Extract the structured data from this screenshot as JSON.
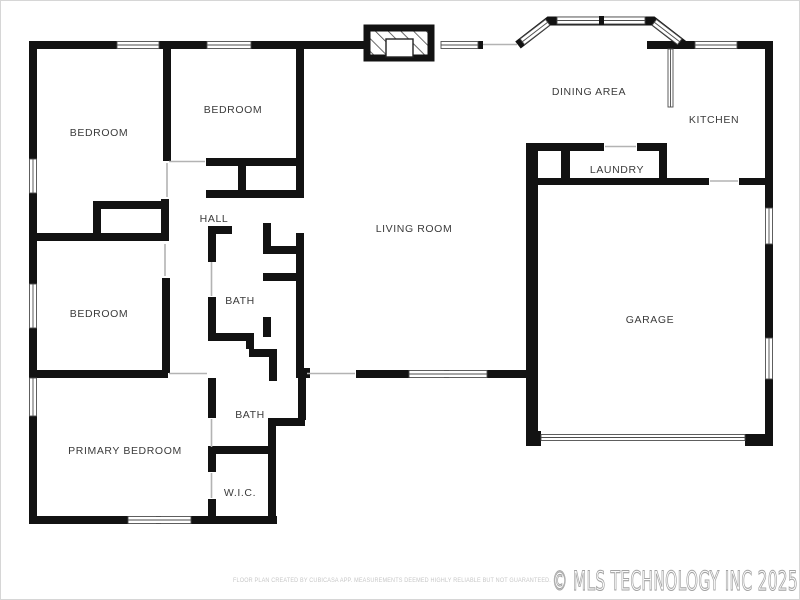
{
  "floor_plan": {
    "rooms": [
      {
        "id": "bedroom-top-left",
        "label": "BEDROOM"
      },
      {
        "id": "bedroom-top-middle",
        "label": "BEDROOM"
      },
      {
        "id": "hall",
        "label": "HALL"
      },
      {
        "id": "bedroom-left",
        "label": "BEDROOM"
      },
      {
        "id": "bath-upper",
        "label": "BATH"
      },
      {
        "id": "bath-lower",
        "label": "BATH"
      },
      {
        "id": "primary-bedroom",
        "label": "PRIMARY BEDROOM"
      },
      {
        "id": "wic",
        "label": "W.I.C."
      },
      {
        "id": "living-room",
        "label": "LIVING ROOM"
      },
      {
        "id": "dining-area",
        "label": "DINING AREA"
      },
      {
        "id": "kitchen",
        "label": "KITCHEN"
      },
      {
        "id": "laundry",
        "label": "LAUNDRY"
      },
      {
        "id": "garage",
        "label": "GARAGE"
      }
    ],
    "footer": {
      "disclaimer": "FLOOR PLAN CREATED BY CUBICASA APP. MEASUREMENTS DEEMED HIGHLY RELIABLE BUT NOT GUARANTEED.",
      "watermark": "© MLS TECHNOLOGY INC 2025"
    },
    "colors": {
      "wall": "#121212",
      "label": "#3b3b3b",
      "watermark_outline": "#a3a3a3",
      "disclaimer_text": "#c7c7c7",
      "background": "#ffffff"
    }
  }
}
